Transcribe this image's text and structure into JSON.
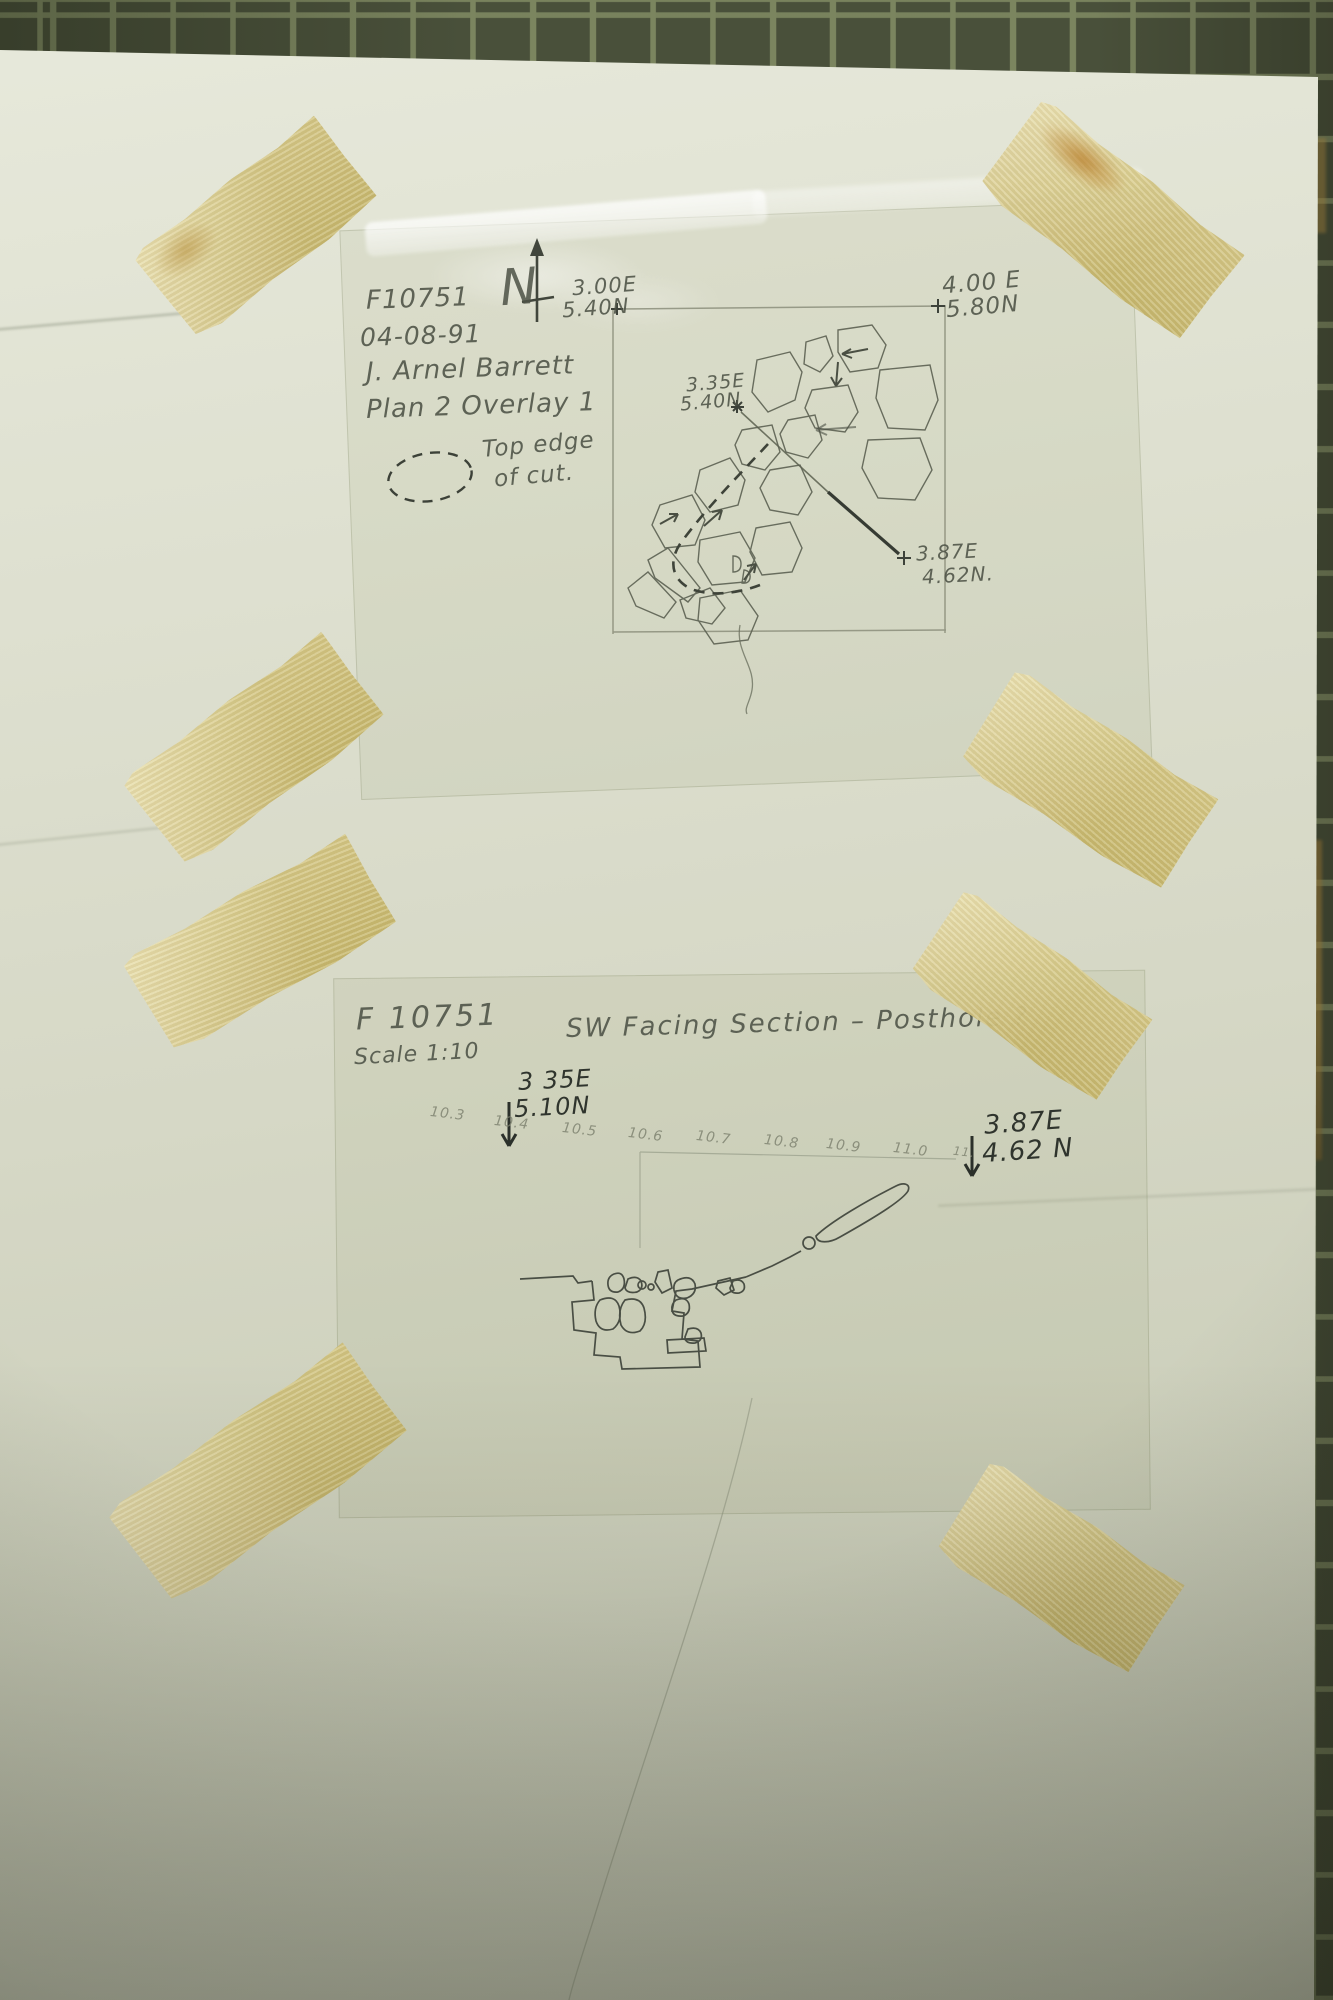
{
  "plan_overlay": {
    "feature_id": "F10751",
    "date": "04-08-91",
    "recorder": "J. Arnel Barrett",
    "title": "Plan 2 Overlay 1",
    "legend_line1": "Top edge",
    "legend_line2": "of cut.",
    "north_label": "N",
    "nw_easting": "3.00E",
    "nw_northing": "5.40N",
    "ne_easting": "4.00 E",
    "ne_northing": "5.80N",
    "pt_a_easting": "3.35E",
    "pt_a_northing": "5.40N",
    "pt_b_easting": "3.87E",
    "pt_b_northing": "4.62N."
  },
  "section_overlay": {
    "feature_id": "F 10751",
    "scale": "Scale 1:10",
    "title": "SW Facing Section – Posthole ?",
    "left_easting": "3 35E",
    "left_northing": "5.10N",
    "right_easting": "3.87E",
    "right_northing": "4.62 N",
    "ticks": [
      "10.3",
      "10.4",
      "10.5",
      "10.6",
      "10.7",
      "10.8",
      "10.9",
      "11.0",
      "11."
    ]
  },
  "colors": {
    "board_tile": "#49503a",
    "board_grout": "#7b855f",
    "paper": "#dee0d0",
    "tape": "#d6c67e",
    "pencil": "#5c6152",
    "ink_dark": "#272c26"
  }
}
